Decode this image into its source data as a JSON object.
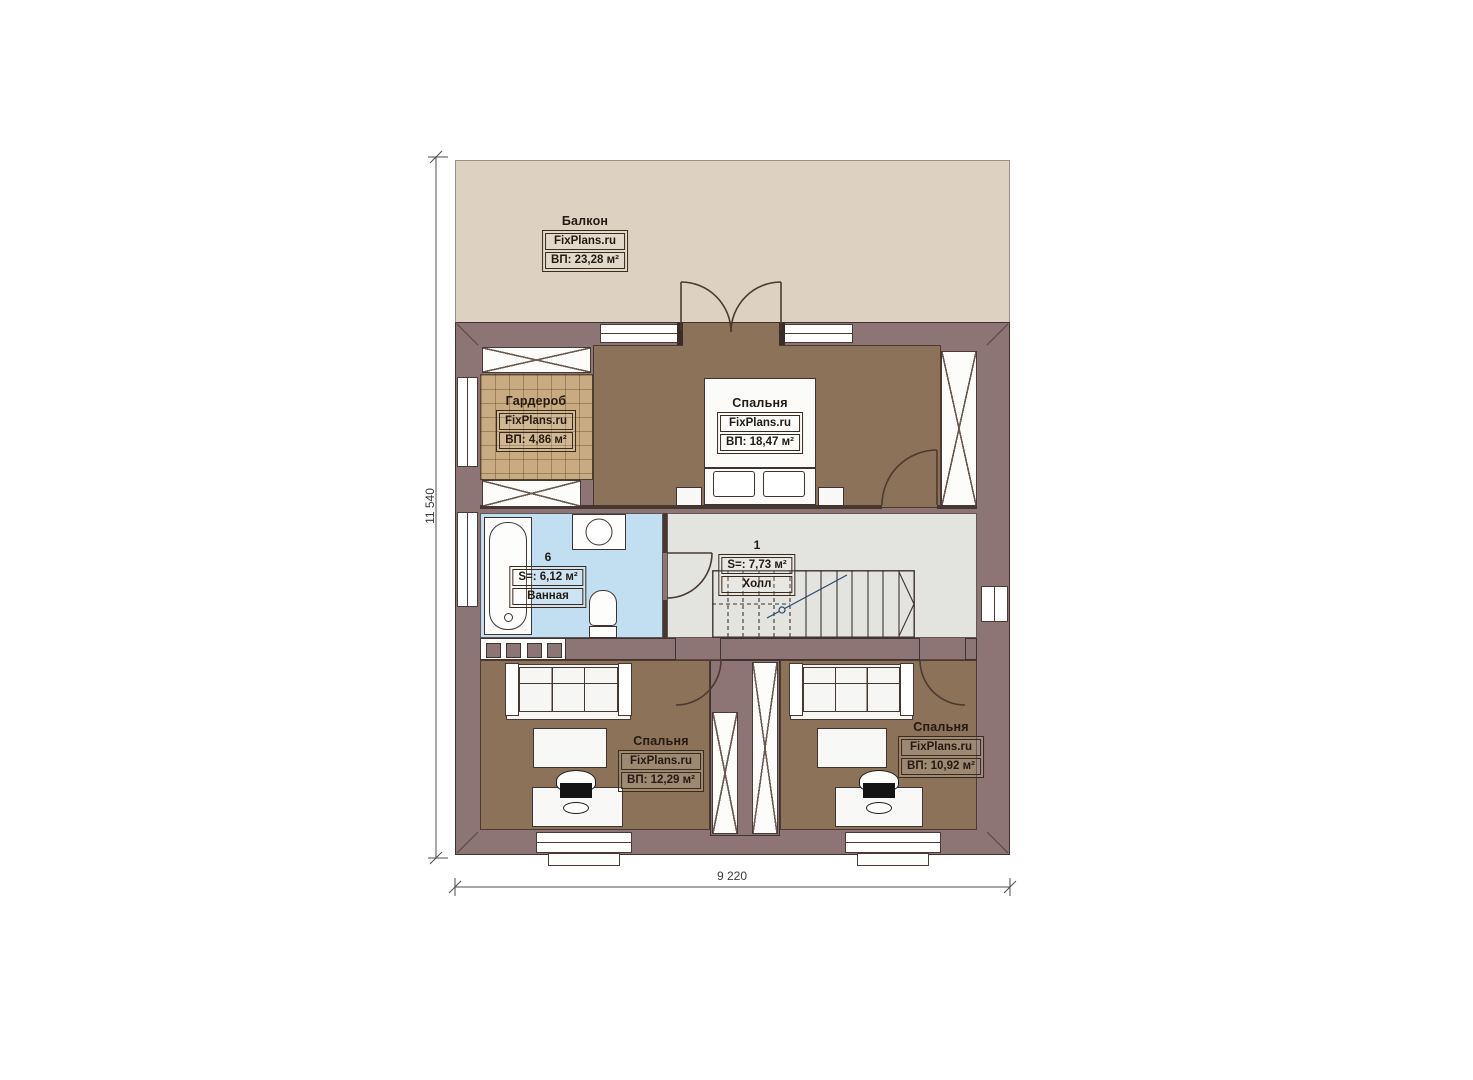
{
  "plan": {
    "brand": "FixPlans.ru",
    "dimensions": {
      "height_label": "11 540",
      "width_label": "9 220"
    },
    "rooms": {
      "balcony": {
        "name": "Балкон",
        "brand": "FixPlans.ru",
        "area": "ВП: 23,28 м²"
      },
      "wardrobe": {
        "name": "Гардероб",
        "brand": "FixPlans.ru",
        "area": "ВП: 4,86 м²"
      },
      "bedroom_top": {
        "name": "Спальня",
        "brand": "FixPlans.ru",
        "area": "ВП: 18,47 м²"
      },
      "bathroom": {
        "number": "6",
        "area": "S=: 6,12 м²",
        "name": "Ванная"
      },
      "hall": {
        "number": "1",
        "area": "S=: 7,73 м²",
        "name": "Холл"
      },
      "bedroom_left": {
        "name": "Спальня",
        "brand": "FixPlans.ru",
        "area": "ВП: 12,29 м²"
      },
      "bedroom_right": {
        "name": "Спальня",
        "brand": "FixPlans.ru",
        "area": "ВП: 10,92 м²"
      }
    }
  },
  "palette": {
    "wall": "#8d7475",
    "wall_line": "#3f3331",
    "floor_bedroom": "#8b7259",
    "floor_wardrobe": "#c8ab81",
    "floor_bath": "#c2def1",
    "floor_hall": "#e3e3e0",
    "floor_balcony": "#ddd2c2",
    "text": "#241a12"
  }
}
